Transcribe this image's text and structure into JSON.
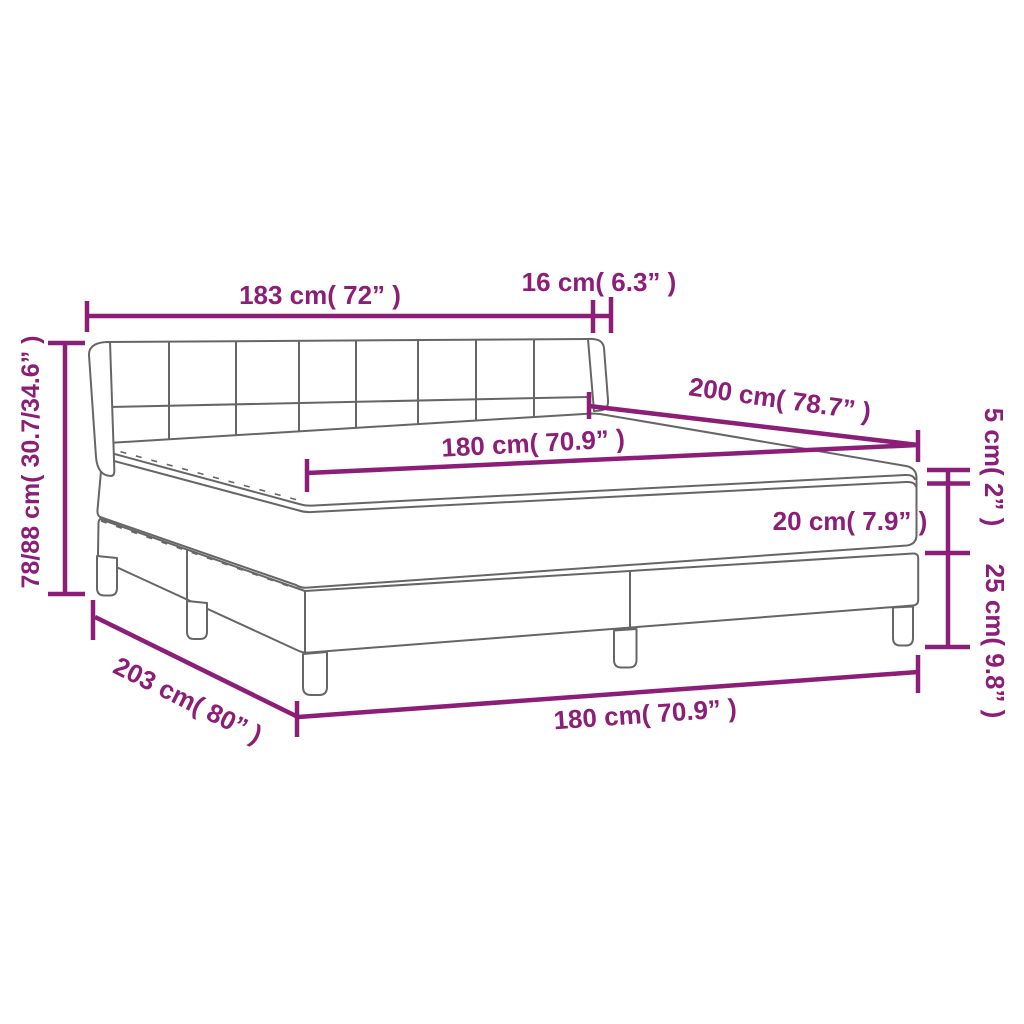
{
  "diagram": {
    "title": "Box spring bed with mattress — dimension diagram",
    "colors": {
      "dimension_accent": "#8C1E78",
      "outline_gray": "#666666",
      "background": "#FFFFFF"
    },
    "labels": {
      "headboard_width": "183 cm( 72” )",
      "wing_depth": "16 cm( 6.3” )",
      "bed_length": "200 cm( 78.7” )",
      "mattress_width": "180 cm( 70.9” )",
      "topper_height": "5 cm( 2” )",
      "mattress_height": "20 cm( 7.9” )",
      "base_height": "25 cm( 9.8” )",
      "total_height": "78/88 cm( 30.7/34.6” )",
      "base_length": "203 cm( 80” )",
      "base_width": "180 cm( 70.9” )"
    }
  }
}
